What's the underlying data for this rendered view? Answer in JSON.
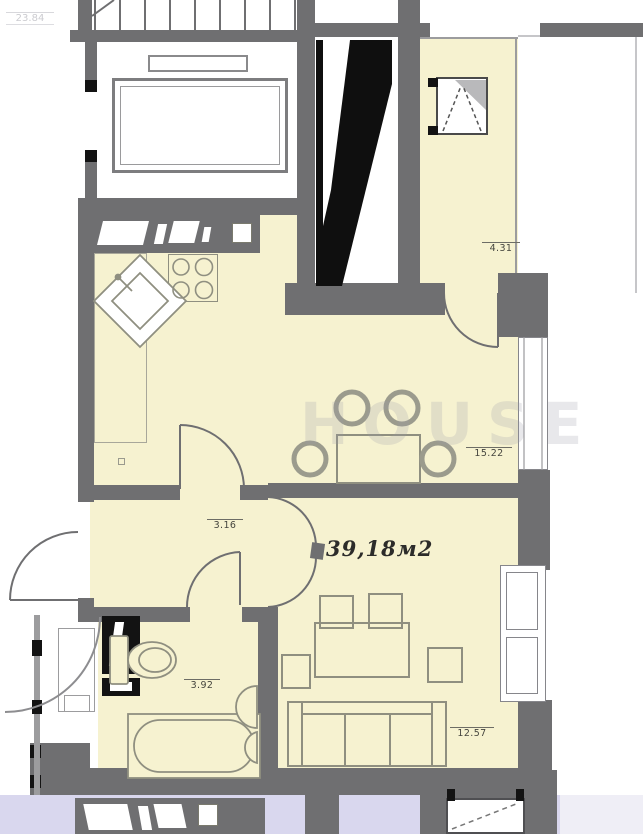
{
  "floorplan": {
    "title_area": "39,18м2",
    "corner_dimension": "23.84",
    "watermark_text": "HOUSE",
    "dimensions": {
      "loggia": "4.31",
      "kitchen_dining": "15.22",
      "hallway": "3.16",
      "bathroom": "3.92",
      "living_room": "12.57"
    },
    "colors": {
      "wall": "#6f6f71",
      "cream": "#f6f2d0",
      "black": "#131313",
      "lav": "#d9d7ee",
      "line": "#8f8f80",
      "labelc": "#45453e",
      "wm": "#9b9ba8",
      "frame": "#86868b",
      "thin": "#9c9c9e"
    }
  }
}
